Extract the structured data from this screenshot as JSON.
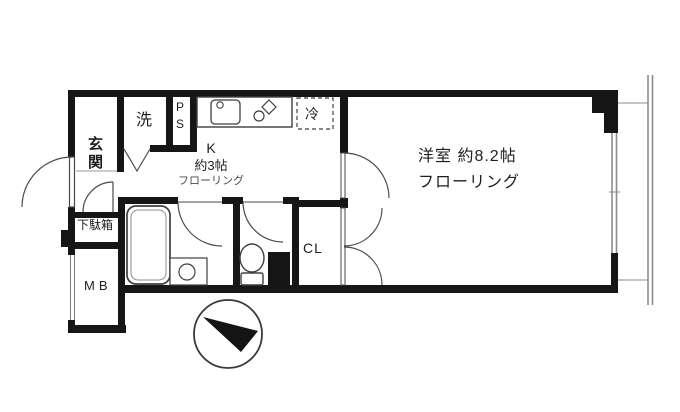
{
  "colors": {
    "background": "#ffffff",
    "wall": "#161616",
    "fixture_line": "#3f3f3f",
    "light_line": "#8c8c8c",
    "text": "#1e1e1e"
  },
  "rooms": {
    "entrance": {
      "label": "玄関"
    },
    "laundry": {
      "label": "洗"
    },
    "pipe_space": {
      "label": "PS"
    },
    "kitchen": {
      "label": "K",
      "size": "約3帖",
      "floor": "フローリング"
    },
    "refrigerator": {
      "label": "冷"
    },
    "western_room": {
      "label": "洋室 約8.2帖",
      "floor": "フローリング"
    },
    "closet": {
      "label": "CL"
    },
    "shoe_cabinet": {
      "label": "下駄箱"
    },
    "meter_box": {
      "label": "MB"
    }
  },
  "compass": {
    "direction": "northwest"
  }
}
